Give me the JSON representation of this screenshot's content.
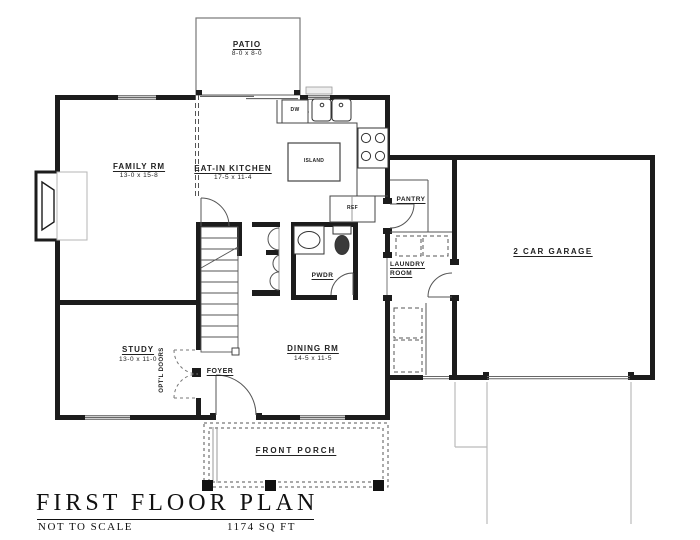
{
  "rooms": {
    "patio": {
      "name": "PATIO",
      "dims": "8-0 x 8-0"
    },
    "family": {
      "name": "FAMILY RM",
      "dims": "13-0 x 15-8"
    },
    "kitchen": {
      "name": "EAT-IN KITCHEN",
      "dims": "17-5 x 11-4"
    },
    "island": {
      "name": "ISLAND"
    },
    "dishwasher": {
      "name": "DW"
    },
    "refrigerator": {
      "name": "REF"
    },
    "pantry": {
      "name": "PANTRY"
    },
    "garage": {
      "name": "2 CAR GARAGE"
    },
    "laundry": {
      "line1": "LAUNDRY",
      "line2": "ROOM"
    },
    "powder": {
      "name": "PWDR"
    },
    "study": {
      "name": "STUDY",
      "dims": "13-0 x 11-0"
    },
    "optional_doors": {
      "name": "OPT'L DOORS"
    },
    "foyer": {
      "name": "FOYER"
    },
    "dining": {
      "name": "DINING RM",
      "dims": "14-5 x 11-5"
    },
    "porch": {
      "name": "FRONT PORCH"
    }
  },
  "title_block": {
    "title": "FIRST FLOOR PLAN",
    "scale_note": "NOT TO SCALE",
    "area": "1174 SQ FT"
  },
  "colors": {
    "wall": "#1c1c1c",
    "line": "#555555",
    "light": "#bbbbbb"
  }
}
